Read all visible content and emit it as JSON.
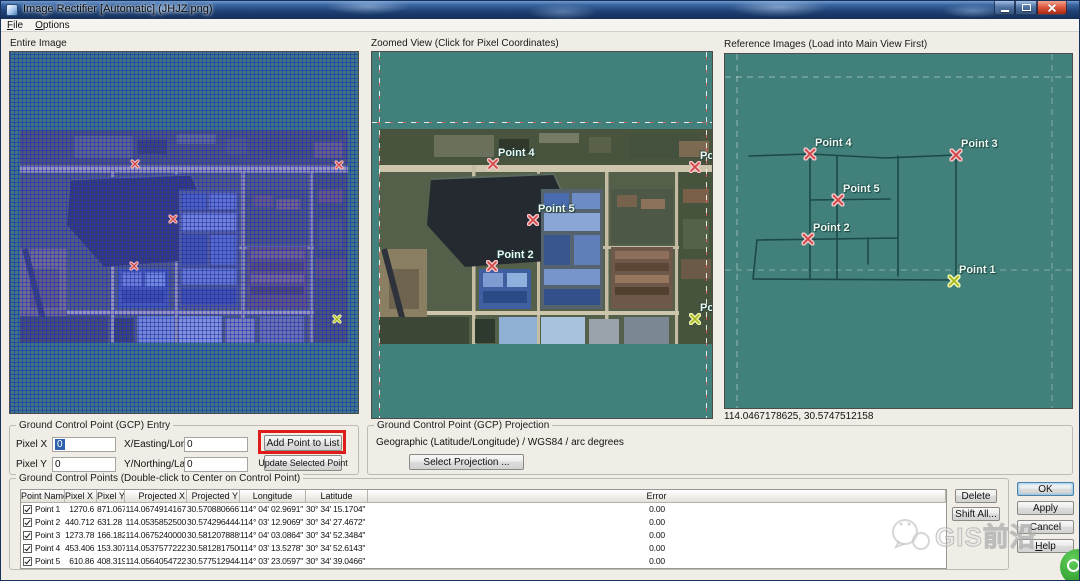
{
  "window": {
    "title": "Image Rectifier [Automatic] (JHJZ.png)"
  },
  "menu": {
    "items": [
      {
        "label": "File"
      },
      {
        "label": "Options"
      }
    ]
  },
  "panels": {
    "entire": {
      "caption": "Entire Image"
    },
    "zoomed": {
      "caption": "Zoomed View (Click for Pixel Coordinates)"
    },
    "reference": {
      "caption": "Reference Images (Load into Main View First)",
      "status": "114.0467178625, 30.5747512158"
    }
  },
  "points": [
    {
      "name": "Point 4",
      "color": "#cf4747",
      "halo": "#f6c8cc",
      "entire": {
        "x": 125,
        "y": 112
      },
      "zoomed": {
        "x": 121,
        "y": 112
      },
      "reference": {
        "x": 85,
        "y": 100
      }
    },
    {
      "name": "Point 3",
      "color": "#cf4747",
      "halo": "#f6c8cc",
      "entire": {
        "x": 329,
        "y": 113
      },
      "zoomed": {
        "x": 323,
        "y": 115
      },
      "reference": {
        "x": 231,
        "y": 101
      }
    },
    {
      "name": "Point 5",
      "color": "#cf4747",
      "halo": "#f6c8cc",
      "entire": {
        "x": 163,
        "y": 167
      },
      "zoomed": {
        "x": 161,
        "y": 168
      },
      "reference": {
        "x": 113,
        "y": 146
      }
    },
    {
      "name": "Point 2",
      "color": "#cf4747",
      "halo": "#f6c8cc",
      "entire": {
        "x": 124,
        "y": 214
      },
      "zoomed": {
        "x": 120,
        "y": 214
      },
      "reference": {
        "x": 83,
        "y": 185
      }
    },
    {
      "name": "Point 1",
      "color": "#a9ba1e",
      "halo": "#f2f6b6",
      "entire": {
        "x": 327,
        "y": 267
      },
      "zoomed": {
        "x": 323,
        "y": 267
      },
      "reference": {
        "x": 229,
        "y": 227
      }
    }
  ],
  "reference_map": {
    "roads": "M24,102 L85,100 L160,104 L231,101 M85,100 L85,225 M112,102 L112,224 M173,102 L173,222 M231,101 L231,227 M85,146 L165,145 M32,186 L173,184 M28,225 L225,226 M32,186 L28,225 M143,184 L143,210"
  },
  "gcp_entry": {
    "caption": "Ground Control Point (GCP) Entry",
    "pixel_x": {
      "label": "Pixel X",
      "value": "0"
    },
    "pixel_y": {
      "label": "Pixel Y",
      "value": "0"
    },
    "easting": {
      "label": "X/Easting/Lon",
      "value": "0"
    },
    "northing": {
      "label": "Y/Northing/Lat",
      "value": "0"
    },
    "add_button": "Add Point to List",
    "update_button": "Update Selected Point"
  },
  "gcp_projection": {
    "caption": "Ground Control Point (GCP) Projection",
    "value": "Geographic (Latitude/Longitude) / WGS84 / arc degrees",
    "select_button": "Select Projection ..."
  },
  "gcp_table": {
    "caption": "Ground Control Points (Double-click to Center on Control Point)",
    "columns": [
      "Point Name",
      "Pixel X",
      "Pixel Y",
      "Projected X",
      "Projected Y",
      "Longitude",
      "Latitude",
      "Error"
    ],
    "rows": [
      {
        "checked": true,
        "name": "Point 1",
        "px": "1270.6",
        "py": "871.067",
        "projx": "114.0674914167",
        "projy": "30.5708806667",
        "lon": "114° 04' 02.9691\" E",
        "lat": "30° 34' 15.1704\" N",
        "err": "0.00"
      },
      {
        "checked": true,
        "name": "Point 2",
        "px": "440.712",
        "py": "631.28",
        "projx": "114.0535852500",
        "projy": "30.5742964444",
        "lon": "114° 03' 12.9069\" E",
        "lat": "30° 34' 27.4672\" N",
        "err": "0.00"
      },
      {
        "checked": true,
        "name": "Point 3",
        "px": "1273.78",
        "py": "166.182",
        "projx": "114.0675240000",
        "projy": "30.5812078889",
        "lon": "114° 04' 03.0864\" E",
        "lat": "30° 34' 52.3484\" N",
        "err": "0.00"
      },
      {
        "checked": true,
        "name": "Point 4",
        "px": "453.406",
        "py": "153.307",
        "projx": "114.0537577222",
        "projy": "30.5812817500",
        "lon": "114° 03' 13.5278\" E",
        "lat": "30° 34' 52.6143\" N",
        "err": "0.00"
      },
      {
        "checked": true,
        "name": "Point 5",
        "px": "610.86",
        "py": "408.319",
        "projx": "114.0564054722",
        "projy": "30.5775129444",
        "lon": "114° 03' 23.0597\" E",
        "lat": "30° 34' 39.0466\" N",
        "err": "0.00"
      }
    ]
  },
  "actions": {
    "delete": "Delete",
    "shift_all": "Shift All...",
    "ok": "OK",
    "apply": "Apply",
    "cancel": "Cancel",
    "help": "Help"
  },
  "watermark": {
    "text": "GIS前沿"
  },
  "colors": {
    "panel_teal": "#41807b",
    "road": "#1c4948",
    "annotation_red": "#e01b1b",
    "marker_red": "#cf4747",
    "marker_yellow": "#a9ba1e",
    "selection_blue": "#2f62ad"
  }
}
